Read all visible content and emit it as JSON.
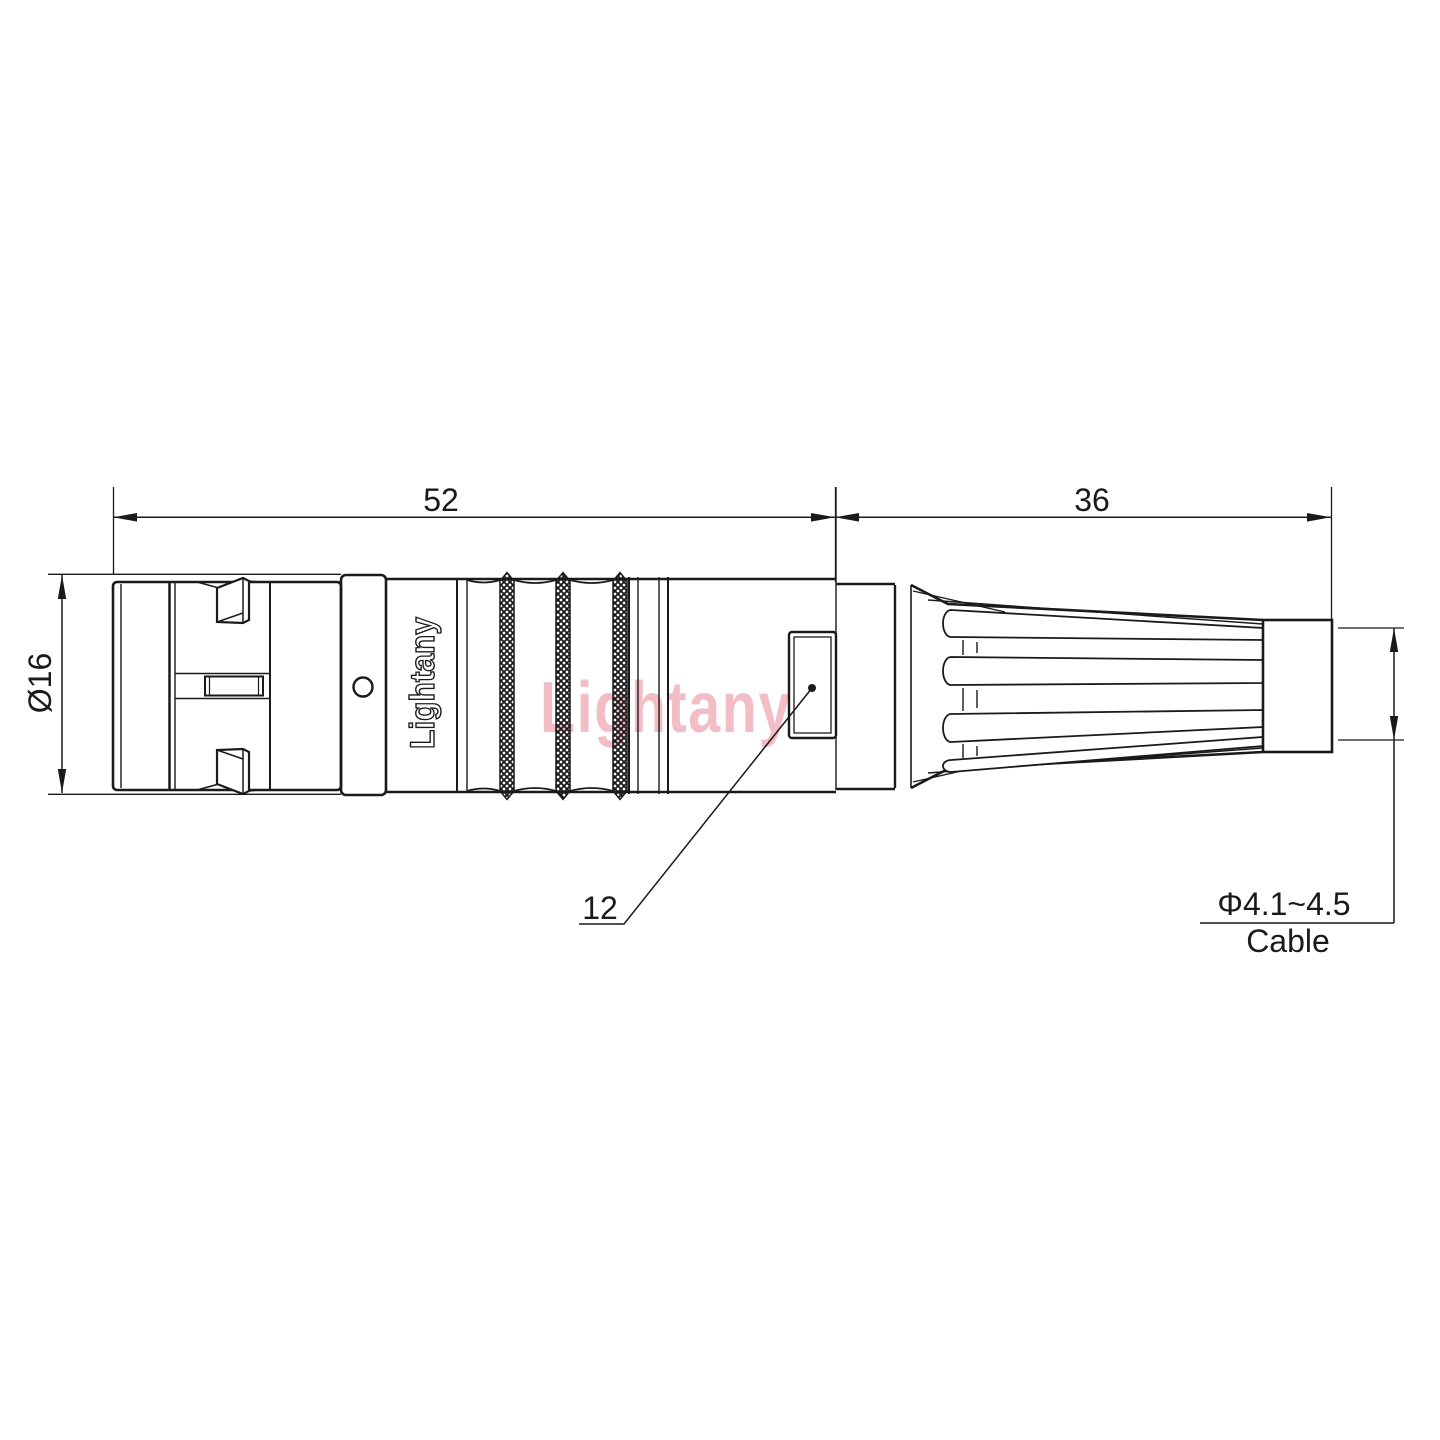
{
  "drawing": {
    "watermark_text": "Lightany",
    "engraving_text": "Lightany",
    "dimensions": {
      "front_length": "52",
      "rear_length": "36",
      "front_diameter": "Ø16",
      "coupling_feature": "12",
      "cable_diameter": "Φ4.1~4.5",
      "cable_caption": "Cable"
    },
    "colors": {
      "line": "#1a1a1a",
      "watermark_pink": "#f1b2bb",
      "background": "#ffffff"
    }
  }
}
